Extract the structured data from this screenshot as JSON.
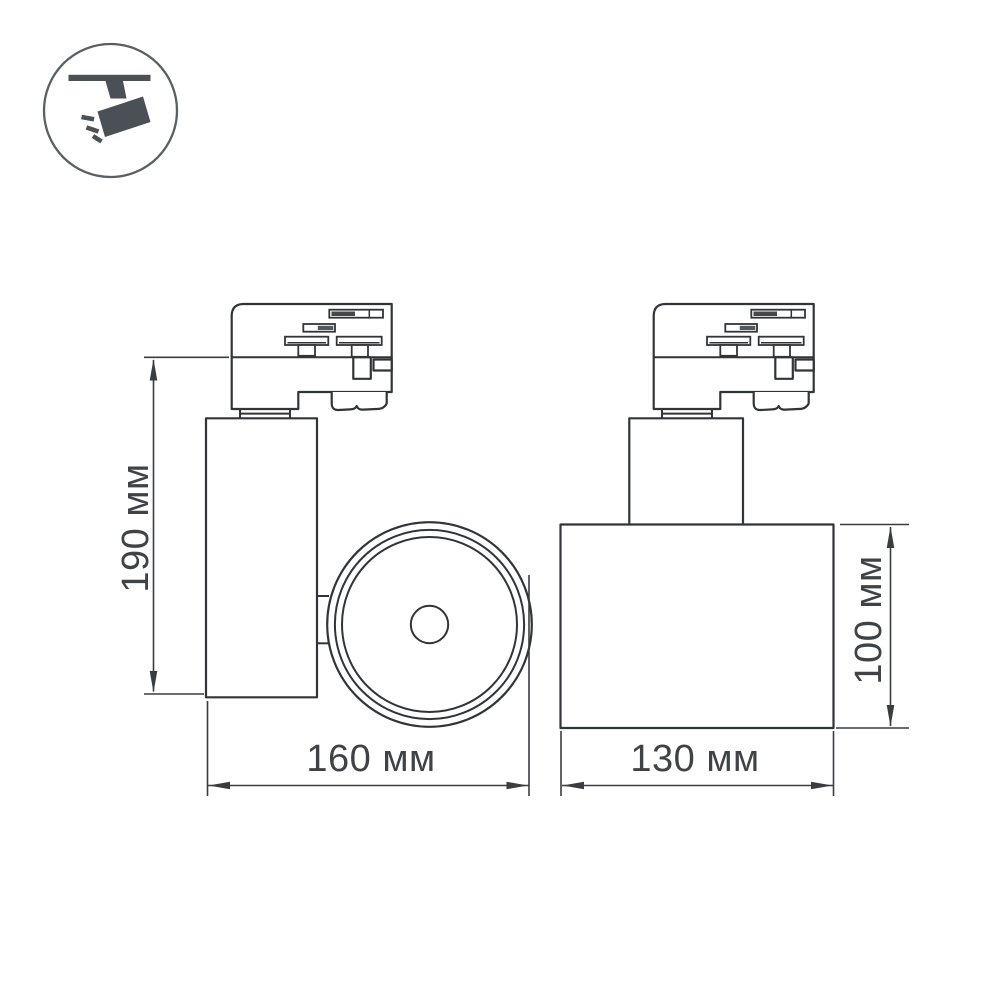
{
  "page": {
    "background": "#ffffff"
  },
  "icon": {
    "name": "ceiling-track-spotlight",
    "fill": "#4a5056",
    "ring_color": "#5a5f63"
  },
  "drawing": {
    "stroke_color": "#323537",
    "label_color": "#404346",
    "side_view": {
      "height_label": "190 мм",
      "width_label": "160 мм"
    },
    "front_view": {
      "height_label": "100 мм",
      "width_label": "130 мм"
    }
  }
}
